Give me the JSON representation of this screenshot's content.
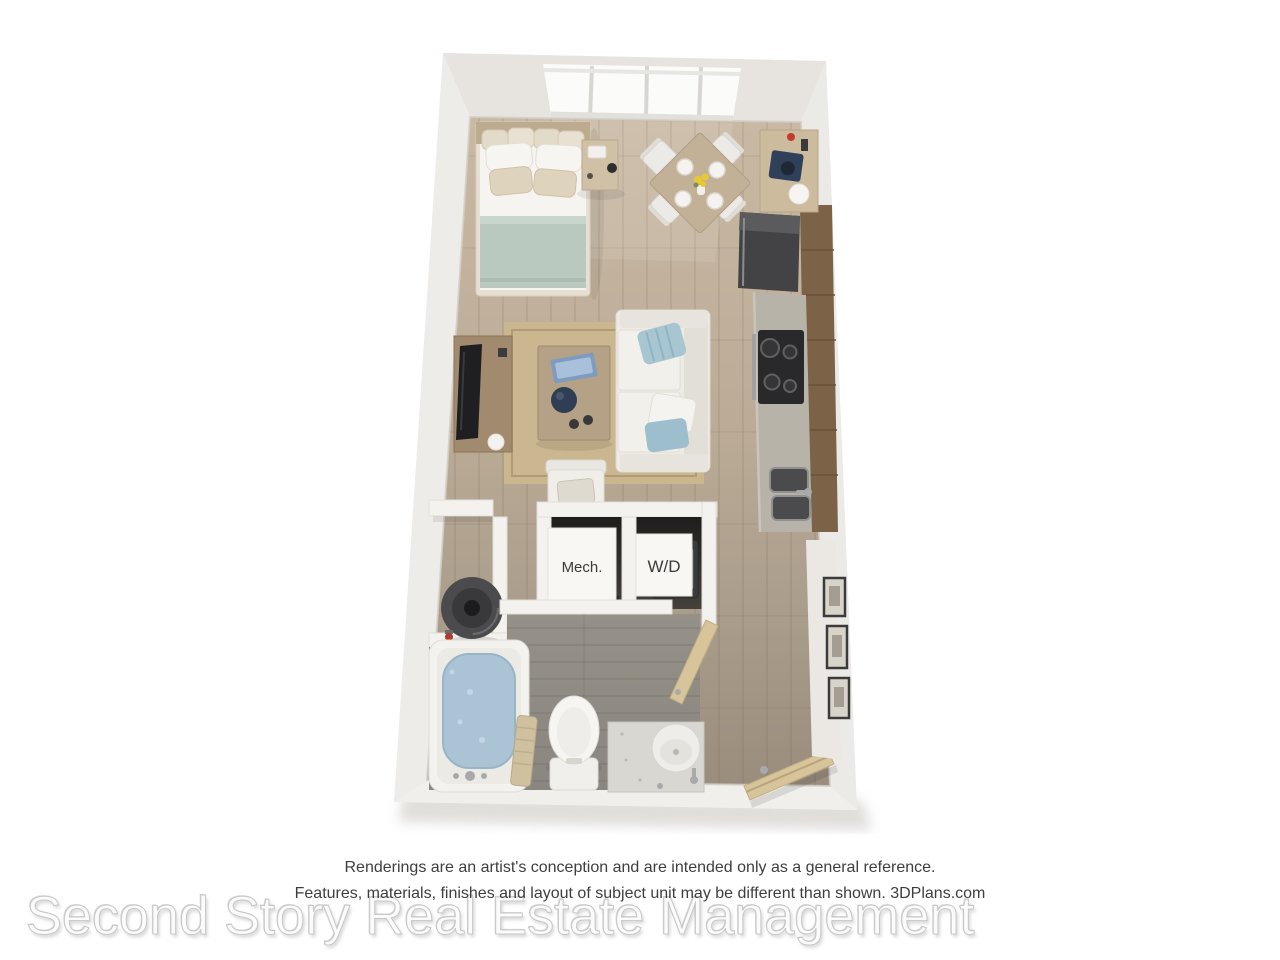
{
  "footer": {
    "disclaimer_line1": "Renderings are an artist's conception and are intended only as a general reference.",
    "disclaimer_line2": "Features, materials, finishes and layout of subject unit may be different than shown. 3DPlans.com",
    "watermark": "Second Story Real Estate Management"
  },
  "floorplan": {
    "labels": {
      "mech_closet": "Mech.",
      "washer_dryer": "W/D"
    },
    "colors": {
      "wall": "#f3f1ee",
      "floor_wood_light": "#c9b9a4",
      "floor_wood_dark": "#9a8d7d",
      "bathroom_floor": "#908c87",
      "rug": "#cab790",
      "sofa": "#edebe5",
      "bed_blanket": "#b9c9bf",
      "tub_water": "#aac4d6",
      "kitchen_counter": "#b7b3a8",
      "cabinet_wood": "#7c6246",
      "appliance_dark": "#434345",
      "door_wood": "#d8c49b",
      "accent_pillow_blue": "#a7c6d2"
    }
  }
}
